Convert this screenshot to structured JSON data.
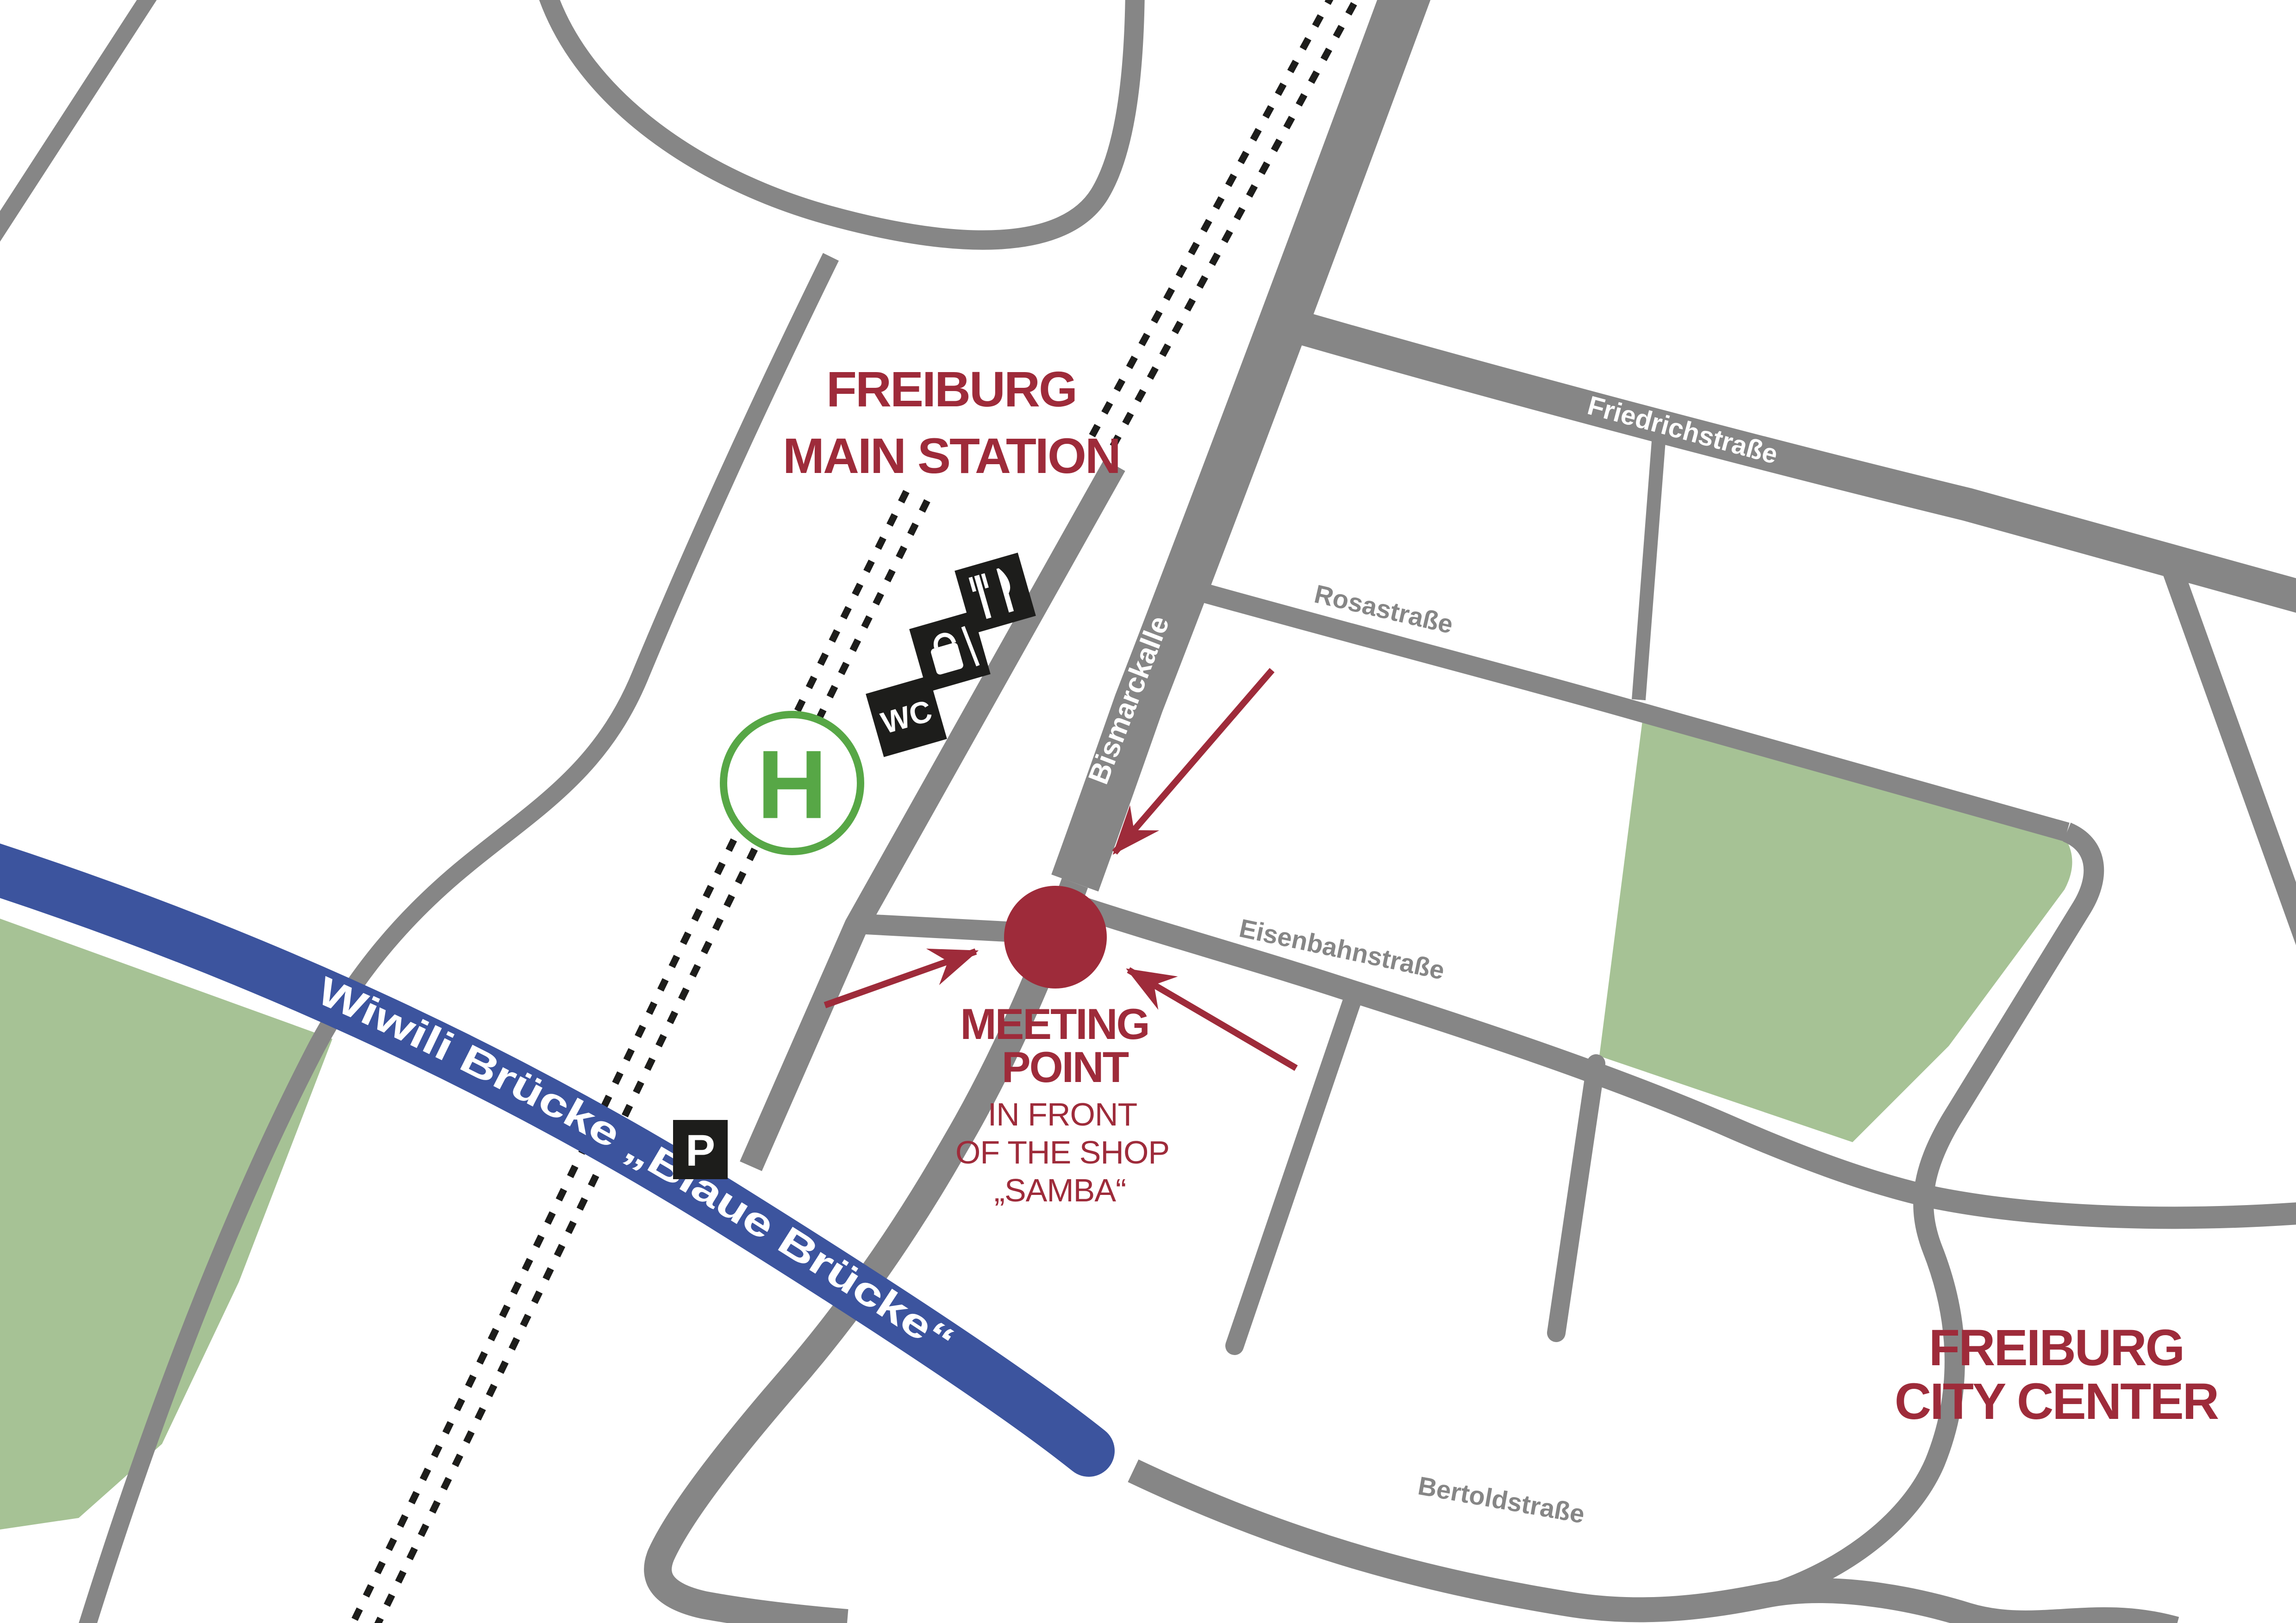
{
  "station": {
    "line1": "FREIBURG",
    "line2": "MAIN STATION"
  },
  "city": {
    "line1": "FREIBURG",
    "line2": "CITY CENTER"
  },
  "meeting": {
    "line1": "MEETING",
    "line2": "POINT",
    "sub1": "IN FRONT",
    "sub2": "OF THE SHOP",
    "sub3": "„SAMBA“"
  },
  "streets": {
    "bismarck": "Bismarckalle",
    "friedrich": "Friedrichstraße",
    "rosa": "Rosastraße",
    "eisenbahn": "Eisenbahnstraße",
    "bertold": "Bertoldstraße",
    "bridge": "Wiwili Brücke „Blaue Brücke“"
  },
  "icons": {
    "tram_stop": "H",
    "parking": "P",
    "wc": "WC",
    "restaurant": "restaurant-icon",
    "shopping": "shopping-bag-icon"
  },
  "colors": {
    "accent_red": "#9E2B3A",
    "road_gray": "#868686",
    "green_area": "#A6C295",
    "bridge_blue": "#3C549E",
    "tram_green": "#57A746",
    "icon_black": "#1D1D1B"
  }
}
